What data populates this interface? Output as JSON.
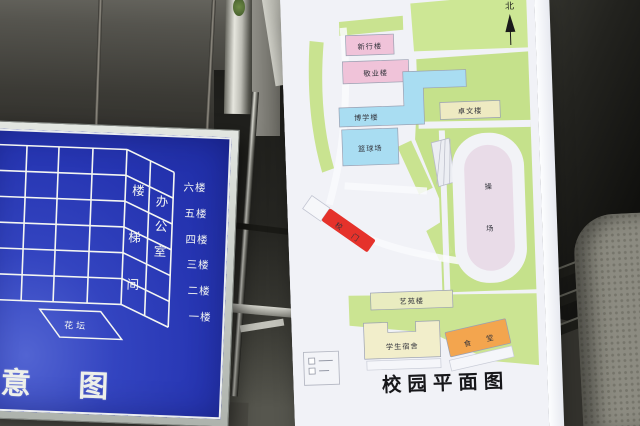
{
  "photo": {
    "left_sign": {
      "floors": [
        "六楼",
        "五楼",
        "四楼",
        "三楼",
        "二楼",
        "一楼"
      ],
      "stair_column": [
        "楼",
        "梯",
        "间"
      ],
      "office_column": [
        "办",
        "公",
        "室"
      ],
      "flower_bed_label": "花坛",
      "bottom_caption": "意 图"
    },
    "campus_map": {
      "north_label": "北",
      "title": "校园平面图",
      "labels": {
        "building_top": "新行楼",
        "building_second": "敬业楼",
        "building_blue": "博学楼",
        "basketball_court": "篮球场",
        "building_east": "卓文楼",
        "playground": [
          "操",
          "场"
        ],
        "school_gate": [
          "校",
          "门"
        ],
        "arts_building": "艺苑楼",
        "dormitory": "学生宿舍",
        "canteen": [
          "食",
          "堂"
        ]
      },
      "colors": {
        "green_area": "#c9e390",
        "building_pink": "#f0c3d9",
        "building_cyan": "#a9ddf2",
        "building_cream": "#eeeac2",
        "canteen_orange": "#f3a54e",
        "gate_red": "#e5322b",
        "field_pink": "#e9dce8",
        "sign_blue": "#2a3ab4"
      }
    }
  }
}
